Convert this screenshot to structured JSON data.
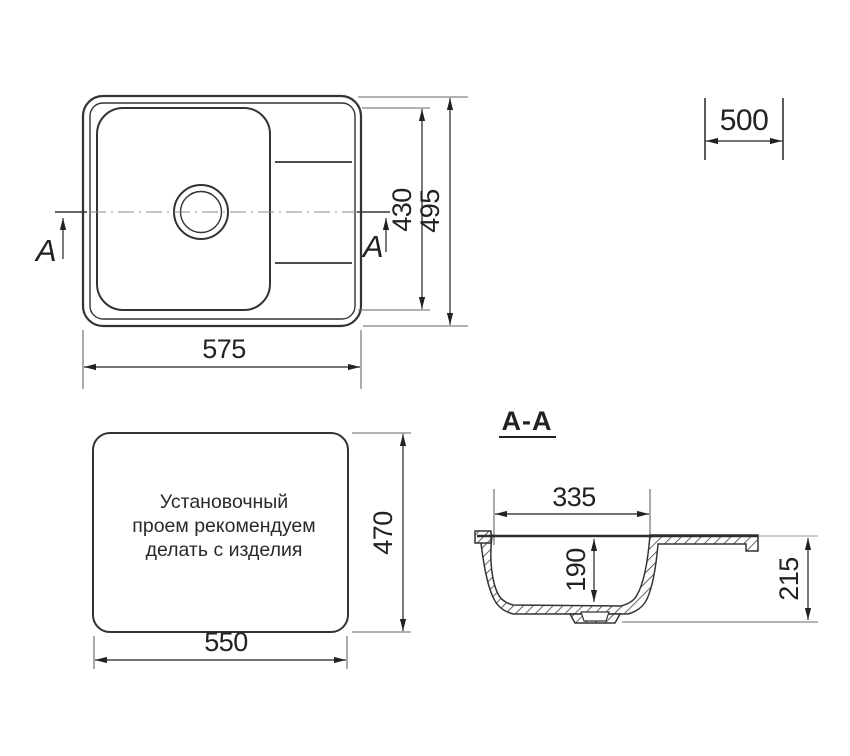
{
  "colors": {
    "line": "#333333",
    "dim": "#222222",
    "extension": "#666666",
    "centerline": "#888888",
    "background": "#ffffff"
  },
  "top_view": {
    "width_label": "575",
    "bowl_height_label": "430",
    "overall_height_label": "495",
    "section_arrow_left": "A",
    "section_arrow_right": "A"
  },
  "cabinet_dim": {
    "label": "500"
  },
  "cutout_view": {
    "note_line1": "Установочный",
    "note_line2": "проем рекомендуем",
    "note_line3": "делать с изделия",
    "height_label": "470",
    "width_label": "550"
  },
  "section_view": {
    "title": "A-A",
    "bowl_width_label": "335",
    "bowl_depth_label": "190",
    "overall_depth_label": "215"
  }
}
